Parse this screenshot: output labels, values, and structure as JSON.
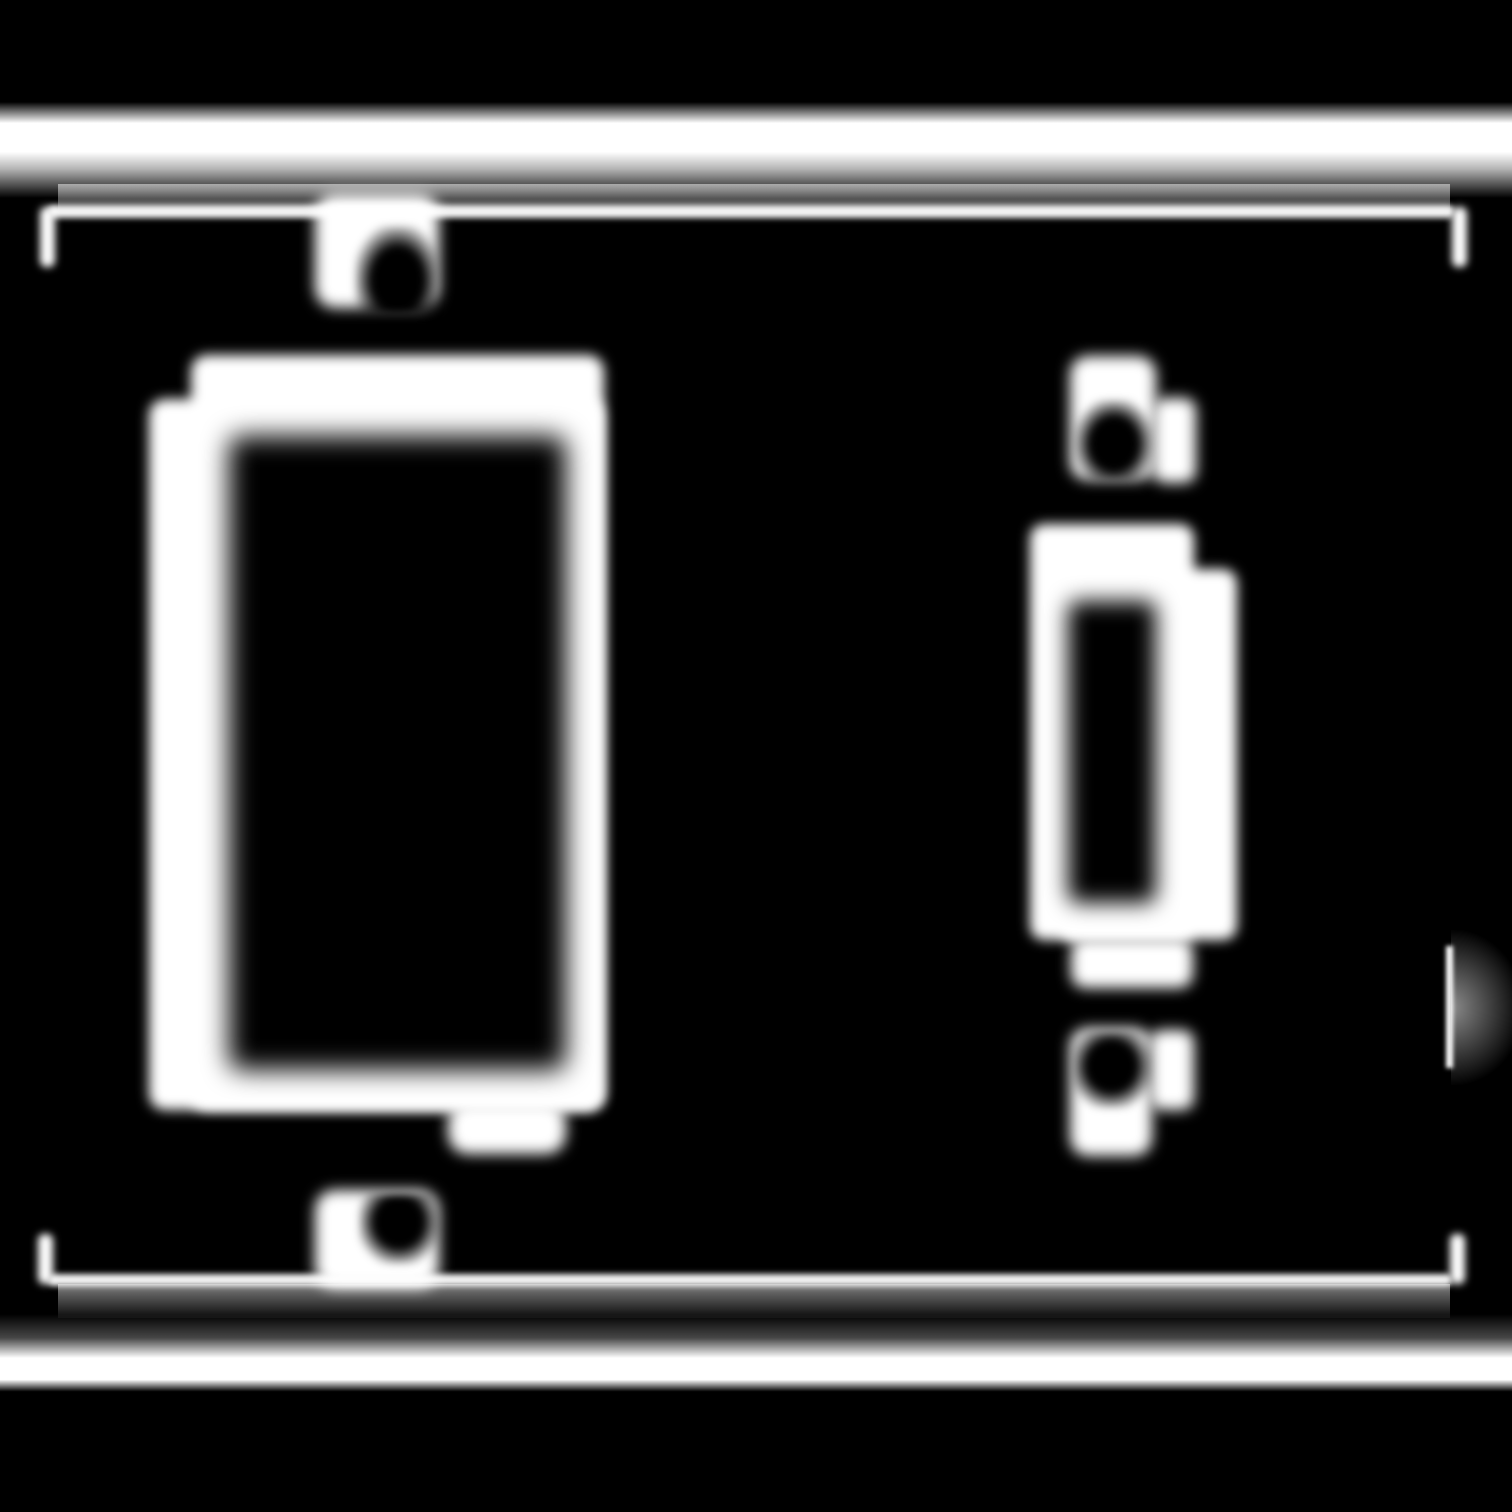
{
  "meta": {
    "title": "Two-gang wall plate line illustration",
    "description": "Blurred white-on-black (inverted glow) line drawing of a two-gang electrical wall plate: a large decora/rocker rectangular cutout on the left and a narrow vertical toggle-switch cutout on the right, each with a slotted screw hole above and below. Bright horizontal bands mark the plate's top and bottom edges, connected by a thin inner outline rectangle whose corners and a short right-edge segment are visible.",
    "canvas": {
      "width": 1512,
      "height": 1512
    },
    "style": "monochrome inverted edge rendering, heavy gaussian blur, no text"
  },
  "colors": {
    "background": "#000000",
    "line": "#ffffff",
    "shadow_gradient_start": "rgba(255,255,255,0.5)",
    "shadow_gradient_end": "rgba(255,255,255,0.05)"
  },
  "components": [
    {
      "name": "plate-top-edge-highlight",
      "role": "bright top edge band of the plate",
      "bbox": [
        0,
        102,
        1512,
        96
      ]
    },
    {
      "name": "plate-top-inner-shadow",
      "role": "soft gradient under the top band",
      "bbox": [
        58,
        184,
        1392,
        30
      ]
    },
    {
      "name": "plate-outline-top-edge",
      "role": "thin inner outline, top side",
      "bbox": [
        48,
        205,
        1406,
        13
      ]
    },
    {
      "name": "plate-outline-top-left-corner",
      "role": "inner outline corner stub",
      "bbox": [
        40,
        207,
        15,
        60
      ]
    },
    {
      "name": "plate-outline-top-right-corner",
      "role": "inner outline corner stub",
      "bbox": [
        1452,
        207,
        15,
        60
      ]
    },
    {
      "name": "plate-outline-bottom-edge",
      "role": "thin inner outline, bottom side",
      "bbox": [
        48,
        1274,
        1404,
        12
      ]
    },
    {
      "name": "plate-bottom-inner-shadow",
      "role": "soft gradient under the bottom outline",
      "bbox": [
        58,
        1284,
        1392,
        34
      ]
    },
    {
      "name": "plate-bottom-edge-highlight",
      "role": "bright bottom edge band of the plate",
      "bbox": [
        0,
        1314,
        1512,
        80
      ]
    },
    {
      "name": "plate-outline-bottom-left-corner",
      "role": "inner outline corner stub",
      "bbox": [
        38,
        1234,
        15,
        50
      ]
    },
    {
      "name": "plate-outline-bottom-right-corner",
      "role": "inner outline corner stub",
      "bbox": [
        1450,
        1234,
        15,
        50
      ]
    },
    {
      "name": "plate-outline-right-edge-segment",
      "role": "visible mid segment of right outline",
      "bbox": [
        1446,
        946,
        7,
        122
      ]
    },
    {
      "name": "plate-right-edge-glow",
      "role": "soft glow right of the outline segment",
      "bbox": [
        1451,
        930,
        72,
        155
      ]
    },
    {
      "name": "rocker-opening-border-outer",
      "role": "white border of decora/rocker cutout (upper)",
      "bbox": [
        191,
        355,
        413,
        755
      ]
    },
    {
      "name": "rocker-opening-border-left",
      "role": "white border of decora/rocker cutout (left step)",
      "bbox": [
        149,
        399,
        455,
        711
      ]
    },
    {
      "name": "rocker-opening-cutout",
      "role": "black interior of decora/rocker cutout",
      "bbox": [
        229,
        436,
        337,
        634
      ]
    },
    {
      "name": "rocker-opening-bottom-tab",
      "role": "small white tab below rocker cutout",
      "bbox": [
        448,
        1102,
        118,
        52
      ]
    },
    {
      "name": "left-top-screw-hole",
      "role": "screw hole above rocker cutout",
      "bbox": [
        315,
        194,
        124,
        114
      ]
    },
    {
      "name": "left-top-screw-slot",
      "role": "dark screw slot inside hole",
      "bbox": [
        355,
        226,
        82,
        88
      ]
    },
    {
      "name": "left-bottom-screw-hole",
      "role": "screw hole below rocker cutout",
      "bbox": [
        315,
        1190,
        124,
        98
      ]
    },
    {
      "name": "left-bottom-screw-slot",
      "role": "dark screw slot inside hole",
      "bbox": [
        359,
        1194,
        80,
        70
      ]
    },
    {
      "name": "toggle-opening-border-main",
      "role": "white border of toggle cutout (main)",
      "bbox": [
        1030,
        524,
        164,
        416
      ]
    },
    {
      "name": "toggle-opening-border-right",
      "role": "white border of toggle cutout (right step)",
      "bbox": [
        1060,
        569,
        177,
        371
      ]
    },
    {
      "name": "toggle-opening-cutout",
      "role": "black interior of toggle cutout",
      "bbox": [
        1068,
        601,
        88,
        302
      ]
    },
    {
      "name": "toggle-opening-bottom-tab",
      "role": "small white tab below toggle cutout",
      "bbox": [
        1071,
        938,
        122,
        50
      ]
    },
    {
      "name": "right-top-screw-hole",
      "role": "screw hole above toggle cutout",
      "bbox": [
        1070,
        356,
        126,
        127
      ]
    },
    {
      "name": "right-top-screw-slot",
      "role": "dark screw slot inside hole",
      "bbox": [
        1075,
        400,
        78,
        80
      ]
    },
    {
      "name": "right-bottom-screw-hole",
      "role": "screw hole below toggle cutout",
      "bbox": [
        1070,
        1028,
        124,
        128
      ]
    },
    {
      "name": "right-bottom-screw-slot",
      "role": "dark screw slot inside hole",
      "bbox": [
        1074,
        1032,
        78,
        76
      ]
    }
  ]
}
